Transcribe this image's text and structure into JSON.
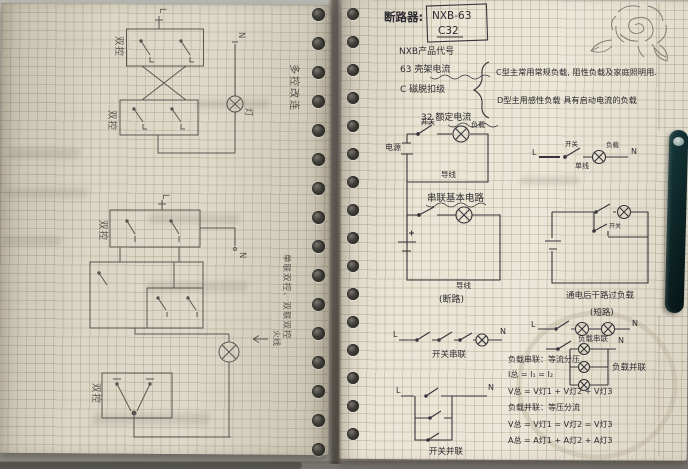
{
  "left_page": {
    "margin_note_top": "多控改连",
    "margin_note_bottom": "单联双控、双联双控",
    "diagram_top": {
      "live": "L",
      "box1": "双控",
      "box2": "双控",
      "neutral": "N",
      "lamp": "灯"
    },
    "diagram_mid": {
      "live": "L",
      "box": "双控",
      "neutral": "N"
    },
    "diagram_bottom": {
      "box": "双控",
      "note": "火线"
    }
  },
  "right_page": {
    "heading": "断路器:",
    "model": {
      "line1": "NXB-63",
      "line2": "C32"
    },
    "notes": {
      "product": "NXB产品代号",
      "frame": "63  壳架电流",
      "trip": "C  磁脱扣级",
      "rated": "32  额定电流"
    },
    "trip_types": {
      "c": "C型主常用常规负载, 阻性负载及家庭照明用.",
      "d": "D型主用感性负载 具有启动电流的负载"
    },
    "series_basic": {
      "source": "电源",
      "switch": "开关",
      "load": "负载",
      "wire": "导线",
      "caption": "串联基本电路"
    },
    "single_line": {
      "live": "L",
      "switch": "开关",
      "load": "负载",
      "wire": "单线",
      "neutral": "N"
    },
    "open_circuit": {
      "wire": "导线",
      "caption": "(断路)"
    },
    "overload": {
      "switch": "开关",
      "caption1": "通电后干路过负载",
      "caption2": "(短路)"
    },
    "switch_series": {
      "live": "L",
      "neutral": "N",
      "caption": "开关串联"
    },
    "load_series": {
      "live": "L",
      "neutral": "N",
      "caption": "负载串联"
    },
    "load_parallel": {
      "neutral": "N",
      "caption": "负载并联"
    },
    "switch_parallel": {
      "live": "L",
      "neutral": "N",
      "caption": "开关并联"
    },
    "formulas": [
      "负载串联：等流分压",
      "I总 = I₁ = I₂",
      "V总 = V灯1 + V灯2 + V灯3",
      "负载并联：等压分流",
      "V总 = V灯1 = V灯2 = V灯3",
      "A总 = A灯1 + A灯2 + A灯3"
    ]
  }
}
